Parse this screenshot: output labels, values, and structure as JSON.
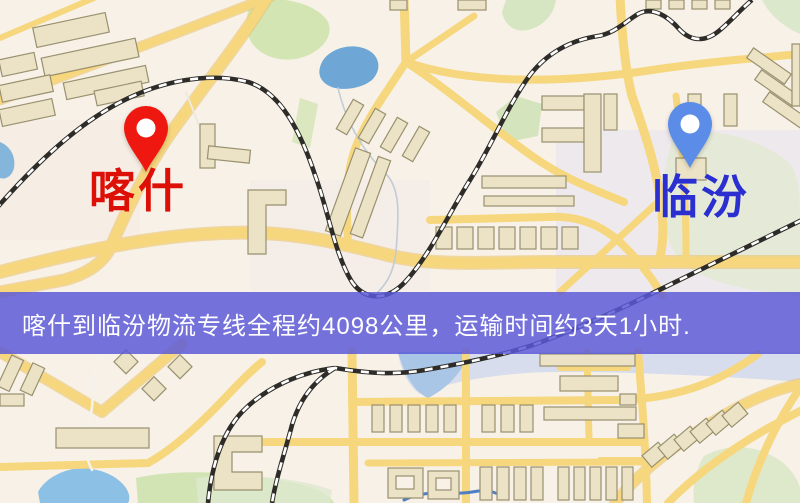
{
  "map": {
    "origin": {
      "name": "喀什",
      "label_color": "#dd1007",
      "pin_color": "#ee1810",
      "pin_icon": "map-pin"
    },
    "destination": {
      "name": "临汾",
      "label_color": "#2b2fd0",
      "pin_color": "#5a8ce8",
      "pin_icon": "map-pin"
    },
    "banner": {
      "text": "喀什到临汾物流专线全程约4098公里，运输时间约3天1小时.",
      "distance_km": "4098",
      "duration": "3天1小时",
      "background": "rgba(91,88,216,0.84)",
      "text_color": "#ffffff"
    },
    "colors": {
      "map_background": "#f7f1e8",
      "road": "#f6d77e",
      "railway": "#2e2c28",
      "building": "#ece3c6",
      "park": "#cfe3b2",
      "water": "#6ea7d6"
    }
  }
}
